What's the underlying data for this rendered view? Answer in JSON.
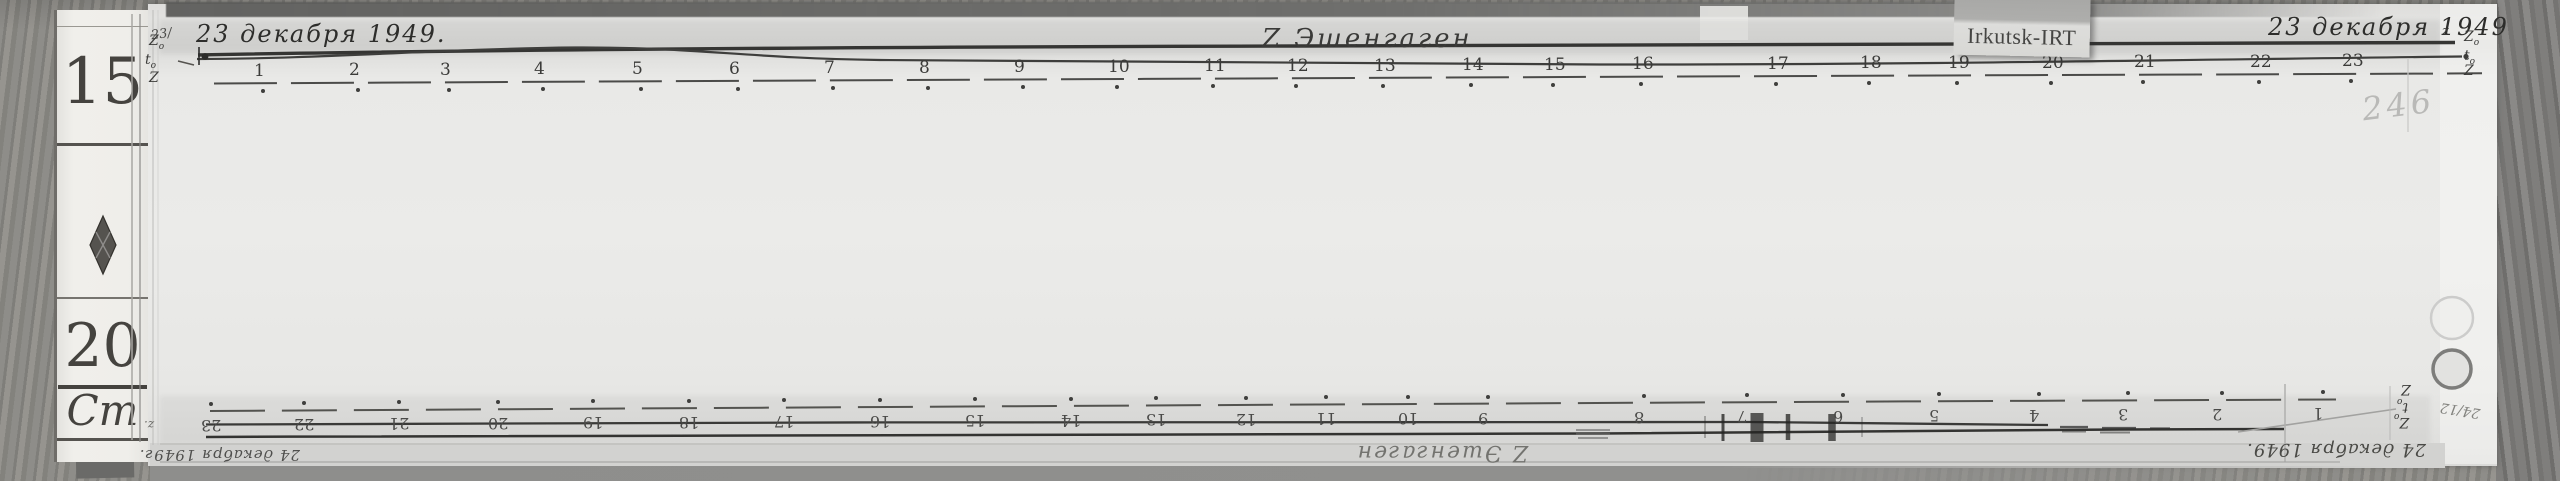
{
  "tag": {
    "label": "Irkutsk-IRT"
  },
  "ruler": {
    "top_mark": "15",
    "middle_mark": "20",
    "unit_mark": "Cm"
  },
  "top_sheet": {
    "date_left": "23 декабря 1949.",
    "note_left": "23/",
    "title": "Z Эшенгаген",
    "date_right": "23 декабря 1949",
    "date_right_sub": "z",
    "faint_number": "246",
    "labels_left": [
      {
        "base": "Z",
        "sub": "o"
      },
      {
        "base": "t",
        "sub": "o"
      },
      {
        "base": "Z",
        "sub": ""
      }
    ],
    "labels_right": [
      {
        "base": "Z",
        "sub": "o"
      },
      {
        "base": "t",
        "sub": "o"
      },
      {
        "base": "Z",
        "sub": ""
      }
    ],
    "hour_marks": [
      {
        "h": "1",
        "x": 262
      },
      {
        "h": "2",
        "x": 357
      },
      {
        "h": "3",
        "x": 448
      },
      {
        "h": "4",
        "x": 542
      },
      {
        "h": "5",
        "x": 640
      },
      {
        "h": "6",
        "x": 737
      },
      {
        "h": "7",
        "x": 832
      },
      {
        "h": "8",
        "x": 927
      },
      {
        "h": "9",
        "x": 1022
      },
      {
        "h": "10",
        "x": 1116
      },
      {
        "h": "11",
        "x": 1212
      },
      {
        "h": "12",
        "x": 1295
      },
      {
        "h": "13",
        "x": 1382
      },
      {
        "h": "14",
        "x": 1470
      },
      {
        "h": "15",
        "x": 1552
      },
      {
        "h": "16",
        "x": 1640
      },
      {
        "h": "17",
        "x": 1775
      },
      {
        "h": "18",
        "x": 1868
      },
      {
        "h": "19",
        "x": 1956
      },
      {
        "h": "20",
        "x": 2050
      },
      {
        "h": "21",
        "x": 2142
      },
      {
        "h": "22",
        "x": 2258
      },
      {
        "h": "23",
        "x": 2350
      }
    ]
  },
  "bottom_sheet": {
    "date_left": "24 декабря 1949г.",
    "title": "Z Эшенгаген",
    "date_right": "24 декабря 1949.",
    "note_right": "24/12",
    "corner_note_left": "z.",
    "labels_right": [
      {
        "base": "Z",
        "sub": ""
      },
      {
        "base": "t",
        "sub": "o"
      },
      {
        "base": "Z",
        "sub": "o"
      }
    ],
    "hour_marks": [
      {
        "h": "1",
        "x": 2322
      },
      {
        "h": "2",
        "x": 2221
      },
      {
        "h": "3",
        "x": 2127
      },
      {
        "h": "4",
        "x": 2038
      },
      {
        "h": "5",
        "x": 1938
      },
      {
        "h": "6",
        "x": 1842
      },
      {
        "h": "7",
        "x": 1746
      },
      {
        "h": "8",
        "x": 1643
      },
      {
        "h": "9",
        "x": 1487
      },
      {
        "h": "10",
        "x": 1407
      },
      {
        "h": "11",
        "x": 1325
      },
      {
        "h": "12",
        "x": 1245
      },
      {
        "h": "13",
        "x": 1155
      },
      {
        "h": "14",
        "x": 1070
      },
      {
        "h": "15",
        "x": 974
      },
      {
        "h": "16",
        "x": 879
      },
      {
        "h": "17",
        "x": 783
      },
      {
        "h": "18",
        "x": 688
      },
      {
        "h": "19",
        "x": 592
      },
      {
        "h": "20",
        "x": 497
      },
      {
        "h": "21",
        "x": 398
      },
      {
        "h": "22",
        "x": 303
      },
      {
        "h": "23",
        "x": 210
      }
    ]
  }
}
